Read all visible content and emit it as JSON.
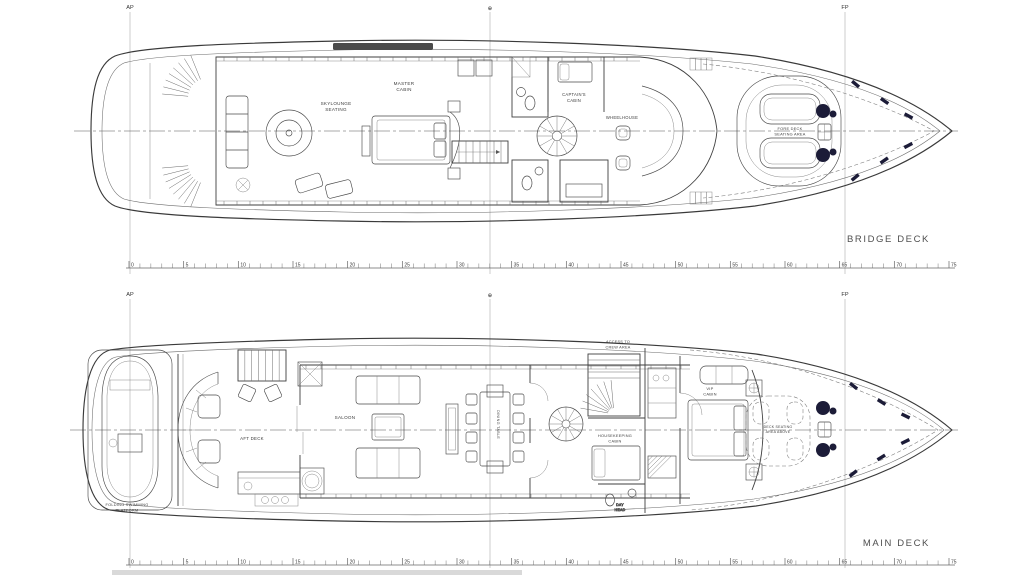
{
  "page": {
    "background": "#ffffff",
    "ink": "#3a3a3a",
    "winch_color": "#1c1c38"
  },
  "datum_markers": {
    "ap": "AP",
    "midship": "⊕",
    "fp": "FP"
  },
  "ruler": {
    "min": 0,
    "max": 75,
    "label_step": 5
  },
  "decks": [
    {
      "title": "BRIDGE DECK",
      "rooms": {
        "skylounge": [
          "SKYLOUNGE",
          "SEATING"
        ],
        "master_cabin": [
          "MASTER",
          "CABIN"
        ],
        "captain_cabin": [
          "CAPTAIN'S",
          "CABIN"
        ],
        "wheelhouse": [
          "WHEELHOUSE"
        ],
        "fore_deck_seating": [
          "FORE DECK",
          "SEATING AREA"
        ]
      }
    },
    {
      "title": "MAIN DECK",
      "rooms": {
        "swim_platform": [
          "FOLDING SWIMMING",
          "PLATFORM"
        ],
        "aft_deck": [
          "AFT DECK"
        ],
        "saloon": [
          "SALOON"
        ],
        "dining_table": [
          "DINING TABLE"
        ],
        "crew_access": [
          "ACCESS TO",
          "CREW AREA"
        ],
        "housekeeping_cabin": [
          "HOUSEKEEPING",
          "CABIN"
        ],
        "day_head": [
          "DAY",
          "HEAD"
        ],
        "vip_cabin": [
          "VIP",
          "CABIN"
        ],
        "bow_seating": [
          "DECK SEATING",
          "AREA ABOVE"
        ]
      }
    }
  ]
}
